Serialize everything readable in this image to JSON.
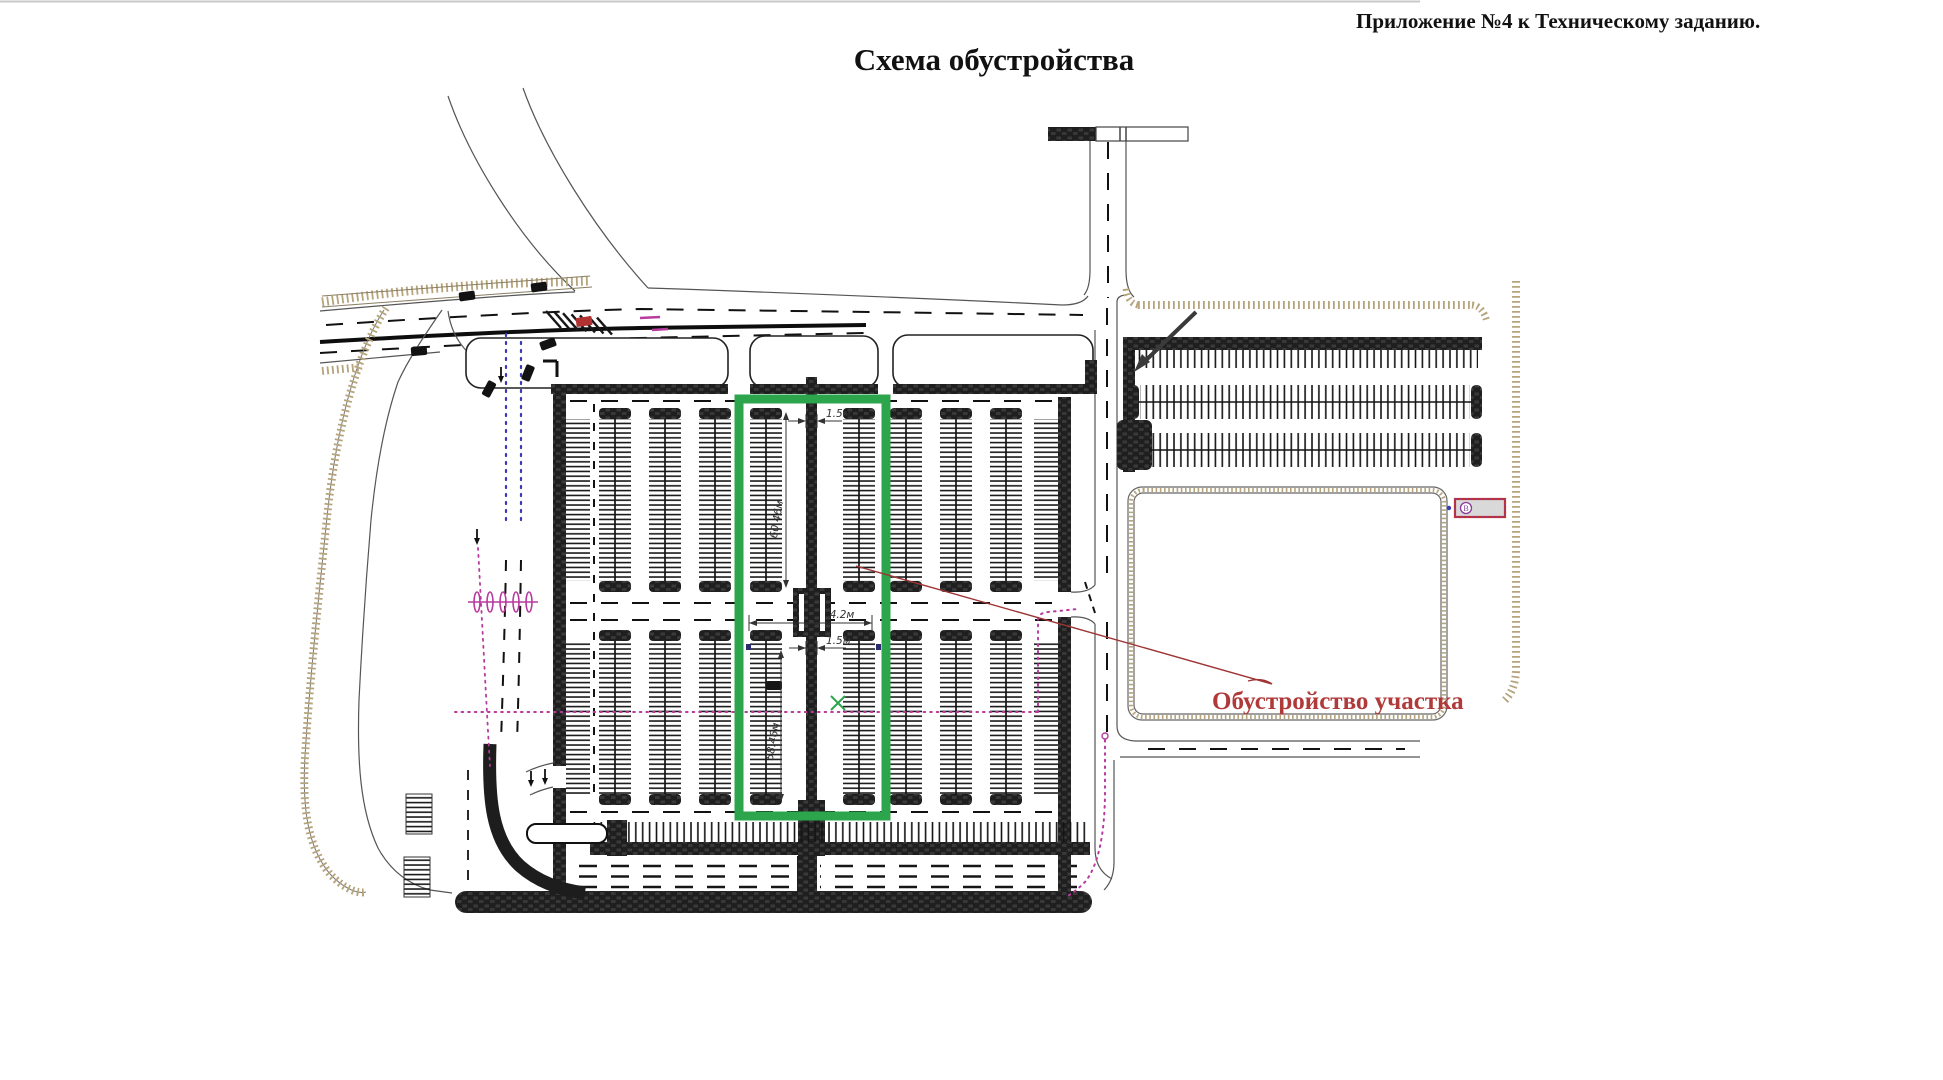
{
  "header": {
    "title": "Схема обустройства",
    "appendix": "Приложение №4 к Техническому заданию."
  },
  "callout": {
    "label": "Обустройство участка"
  },
  "dims": {
    "d1": "60.46м",
    "d2": "1.5м",
    "d3": "4.2м",
    "d4": "1.5м",
    "d5": "58.46м"
  },
  "symbols": {
    "bus_stop": "В"
  },
  "markers": {
    "vehicle": "car-marker",
    "crossing": "pedestrian-crossing",
    "trees": "tree-row-markers",
    "bus_stop": "bus-stop-symbol"
  },
  "colors": {
    "highlight": "#2ca54d",
    "callout": "#b03a3a",
    "leader": "#9e3434",
    "curb": "#b5a47c",
    "utility_magenta": "#b73a9e",
    "guide_blue": "#3a3ab7",
    "ink": "#1c1c1c"
  }
}
